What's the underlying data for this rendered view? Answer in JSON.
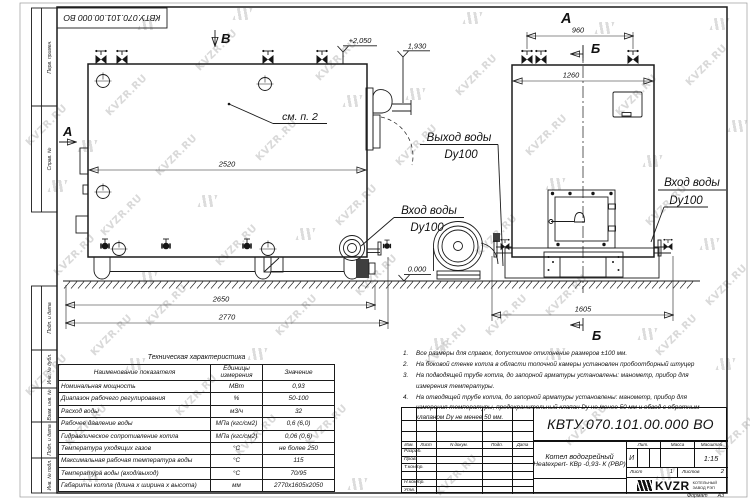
{
  "sheet": {
    "stamp": "КВТУ.070.101.00.000  ВО",
    "watermark_text": "KVZR.RU",
    "format_label": "Формат",
    "format_value": "А3",
    "margin_labels": [
      "Перв. примен.",
      "Справ. №",
      "Подп. и дата",
      "Инв. № дубл.",
      "Взам. инв. №",
      "Подп. и дата",
      "Инв. № подл."
    ]
  },
  "views": {
    "side": {
      "section_a": "А",
      "view_b": "В",
      "see_note": "см. п. 2",
      "dim_2520": "2520",
      "dim_2650": "2650",
      "dim_2770": "2770",
      "elev_top": "+2,050",
      "elev_pipe": "1,930",
      "elev_zero": "0.000",
      "label_outlet_1": "Выход воды",
      "label_outlet_2": "Dy100",
      "label_inlet_1": "Вход воды",
      "label_inlet_2": "Dy100"
    },
    "front": {
      "view_a": "А",
      "section_b_top": "Б",
      "section_b_bottom": "Б",
      "dim_960": "960",
      "dim_1260": "1260",
      "dim_1605": "1605",
      "label_inlet_1": "Вход воды",
      "label_inlet_2": "Dy100"
    }
  },
  "notes": {
    "items": [
      {
        "num": "1.",
        "text": "Все размеры для справок, допустимое отклонение размеров ±100 мм."
      },
      {
        "num": "2.",
        "text": "На боковой стенке котла в области топочной камеры установлен пробоотборный штуцер"
      },
      {
        "num": "3.",
        "text": "На  подводящей трубе котла, до запорной арматуры установлены: манометр, прибор для измерения температуры."
      },
      {
        "num": "4.",
        "text": "На отводящей трубе котла, до запорной арматуры установлены: манометр, прибор для измерения температуры, предохранительный клапан Dу не менее 50 мм и обвод с обратным клапаном Dу не менее 50 мм."
      }
    ]
  },
  "spec_table": {
    "title": "Техническая характеристика",
    "headers": [
      "Наименование показателя",
      "Единицы измерения",
      "Значение"
    ],
    "rows": [
      [
        "Номинальная мощность",
        "МВт",
        "0,93"
      ],
      [
        "Диапазон рабочего регулирования",
        "%",
        "50-100"
      ],
      [
        "Расход воды",
        "м3/ч",
        "32"
      ],
      [
        "Рабочее давление воды",
        "МПа (кгс/см2)",
        "0,6 (6,0)"
      ],
      [
        "Гидравлическое сопротивление котла",
        "МПа (кгс/см2)",
        "0,06 (0,6)"
      ],
      [
        "Температура уходящих газов",
        "°С",
        "не более 250"
      ],
      [
        "Максимальная рабочая температура воды",
        "°С",
        "115"
      ],
      [
        "Температура воды (вход/выход)",
        "°С",
        "70/95"
      ],
      [
        "Габариты котла (длина х ширина х высота)",
        "мм",
        "2770х1605х2050"
      ]
    ]
  },
  "title_block": {
    "designation": "КВТУ.070.101.00.000  ВО",
    "product_line1": "Котел водогрейный",
    "product_line2": "Heatexpert- КВр -0,93- К (РВР)",
    "cols": [
      "Изм.",
      "Лист",
      "N докум.",
      "Подп.",
      "Дата"
    ],
    "sign_rows": [
      "Разраб.",
      "Пров.",
      "Т.контр.",
      "",
      "Н.контр.",
      "Утв."
    ],
    "lit_label": "Лит.",
    "mass_label": "Масса",
    "scale_label": "Масштаб",
    "lit_value": "И",
    "scale_value": "1:15",
    "sheet_label": "Лист",
    "sheet_value": "1",
    "sheets_label": "Листов",
    "sheets_value": "2",
    "logo_text": "KVZR",
    "logo_sub1": "КОТЕЛЬНЫЙ",
    "logo_sub2": "ЗАВОД РЭП"
  }
}
